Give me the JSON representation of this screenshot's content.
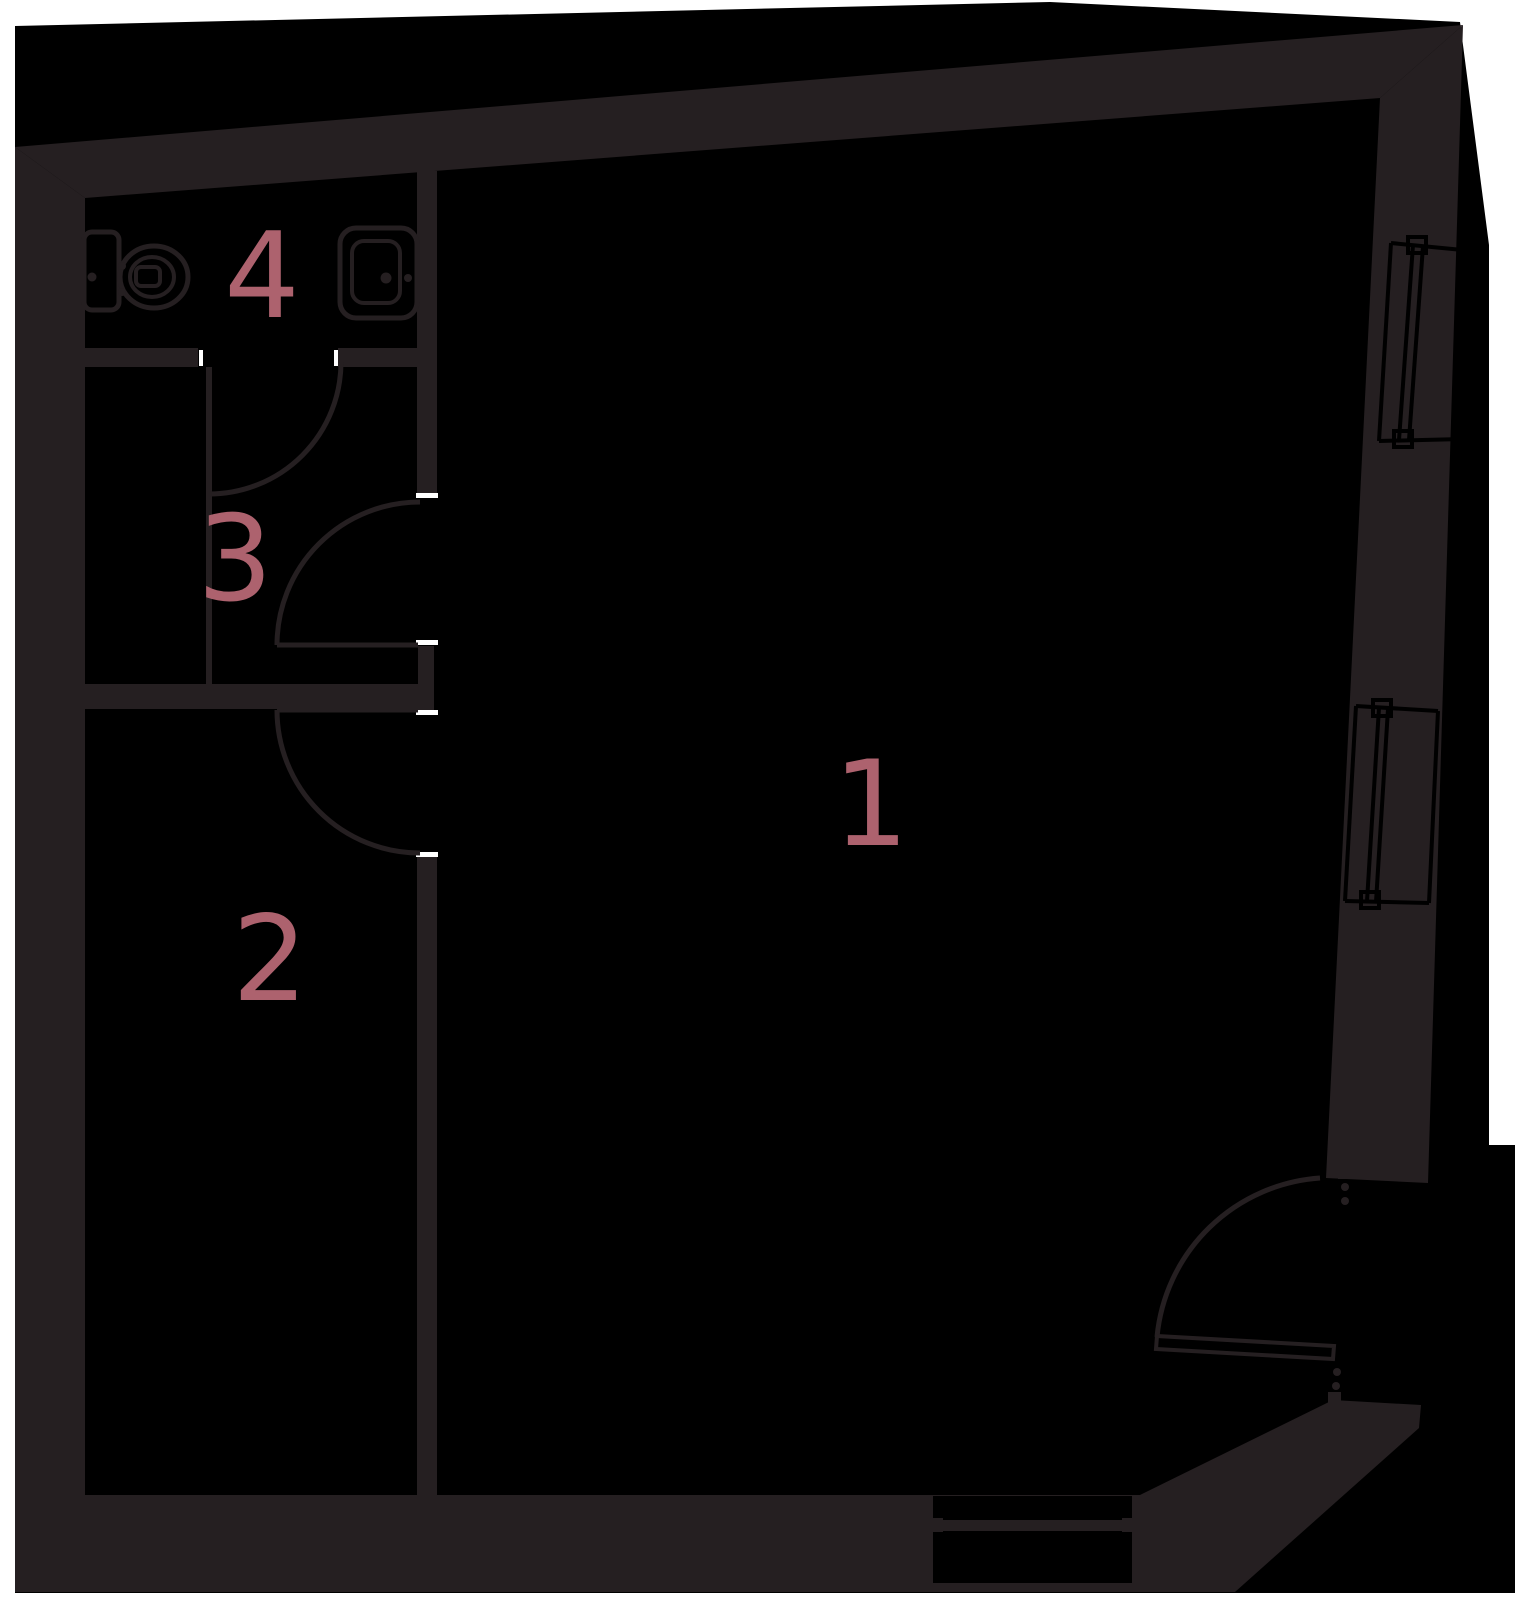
{
  "image_type": "apartment floor plan",
  "colors": {
    "page": "#ffffff",
    "floor": "#000000",
    "wall": "#251f21",
    "accent": "#ad626e"
  },
  "rooms": [
    {
      "label": "1"
    },
    {
      "label": "2"
    },
    {
      "label": "3"
    },
    {
      "label": "4"
    }
  ],
  "fixtures": {
    "toilet_location": "room 4",
    "washbasin_location": "room 4"
  },
  "openings": {
    "interior_doors": 3,
    "entrance_door": 1,
    "right_wall_windows": 2,
    "bottom_wall_windows": 1
  }
}
